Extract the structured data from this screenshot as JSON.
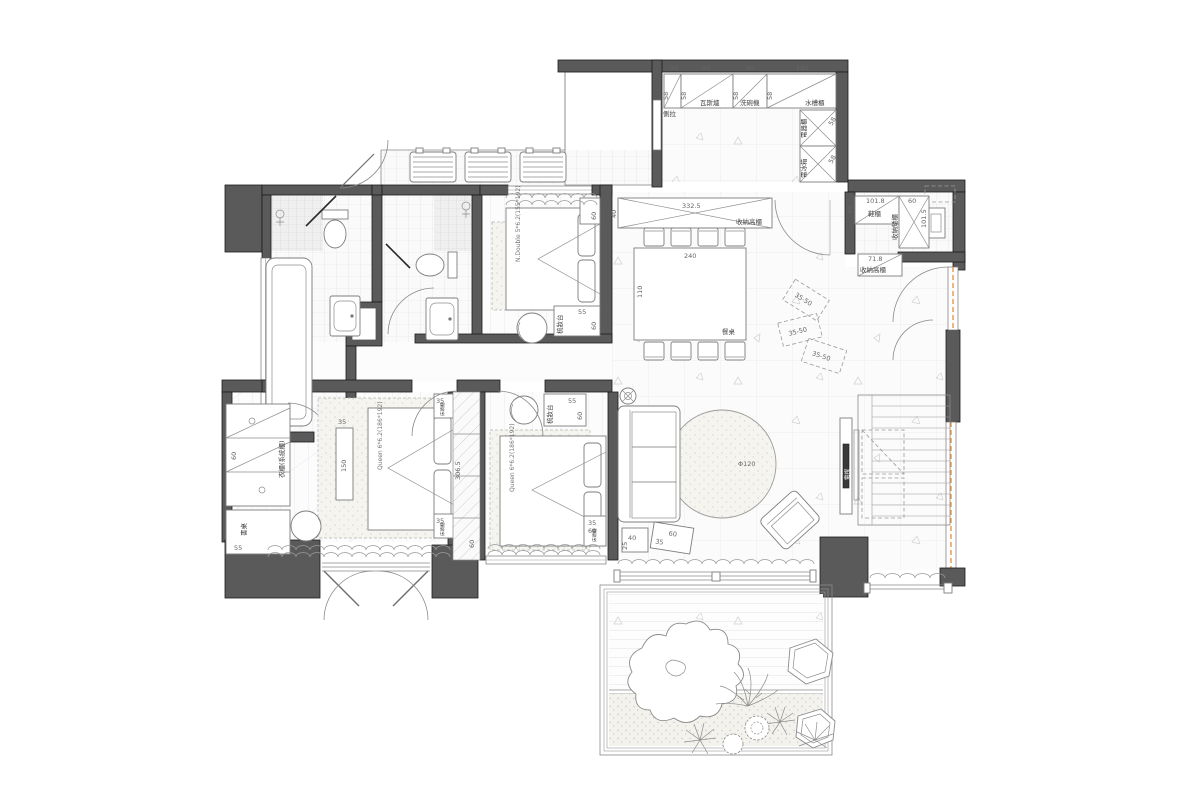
{
  "title": "apartment-floor-plan",
  "colors": {
    "wall": "#5a5a5a",
    "line": "#8a8a8a",
    "accent_orange": "#e0872e",
    "text": "#555555"
  },
  "labels": {
    "kitchen": {
      "dim30": "30",
      "dim90": "90",
      "dim60": "60",
      "dim120": "120",
      "c1": "側拉",
      "c2": "瓦斯爐",
      "c3": "洗碗機",
      "c4": "水槽櫃",
      "d58": "58",
      "r1": "電器櫃",
      "r2": "電冰箱"
    },
    "entry": {
      "shoe": "鞋櫃",
      "shoe_dim": "101.8",
      "d40": "40",
      "cab_dim": "60",
      "cab_len": "101.5",
      "cab": "收納矮櫃",
      "tall": "收納高櫃",
      "tall_dim": "71.8"
    },
    "dining": {
      "cab": "收納高櫃",
      "cab_dim": "332.5",
      "d40": "40",
      "table": "餐桌",
      "table_dim": "240",
      "table_depth": "110"
    },
    "living": {
      "tv": "電視",
      "rug": "Φ120",
      "t1w": "40",
      "t1d": "25",
      "t2w": "60",
      "t2d": "35",
      "box": "35-50"
    },
    "bedroom_top": {
      "bed": "N.Double 5*6.2(155*192)",
      "dresser": "梳妝台",
      "d55": "55",
      "d60": "60"
    },
    "bedroom_master": {
      "bed": "Queen 6*6.2(186*192)",
      "bench_w": "35",
      "bench_l": "150",
      "bedside": "床頭櫃",
      "d35": "35",
      "d60": "60",
      "wardrobe": "衣櫃(系統櫃)",
      "desk": "書桌",
      "d55": "55"
    },
    "bedroom_second": {
      "bed": "Queen 6*6.2(186*192)",
      "dresser": "梳妝台",
      "d55": "55",
      "d60": "60",
      "bedside": "床頭櫃",
      "d35": "35",
      "closet_len": "306.5",
      "closet_d": "60"
    }
  }
}
